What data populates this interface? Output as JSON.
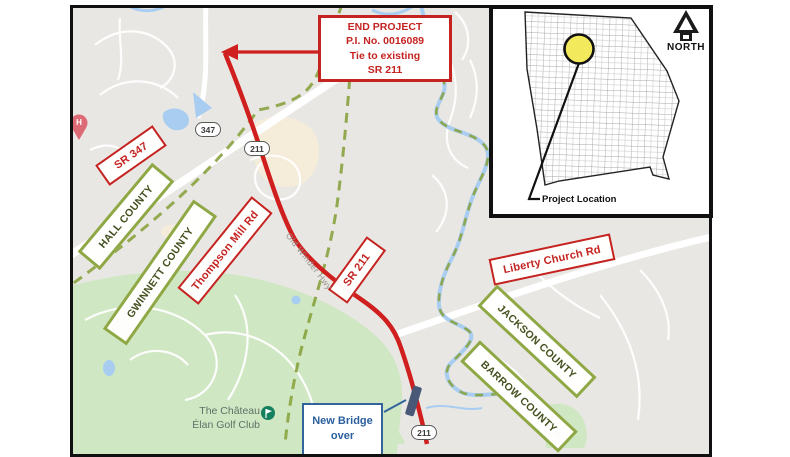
{
  "main_map": {
    "end_project_callout": {
      "lines": [
        "END PROJECT",
        "P.I. No. 0016089",
        "Tie to existing",
        "SR 211"
      ]
    },
    "road_labels": {
      "sr_347": "SR 347",
      "thompson_mill": "Thompson Mill Rd",
      "sr_211": "SR 211",
      "liberty_church": "Liberty Church Rd"
    },
    "county_labels": {
      "hall": "HALL COUNTY",
      "gwinnett": "GWINNETT COUNTY",
      "jackson": "JACKSON COUNTY",
      "barrow": "BARROW COUNTY"
    },
    "route_shields": {
      "sr_347": "347",
      "sr_211_north": "211",
      "sr_211_south": "211"
    },
    "street_name": "Old Winder Hwy",
    "bridge_callout": {
      "lines": [
        "New Bridge",
        "over"
      ]
    },
    "pois": {
      "golf_club_line1": "The Château",
      "golf_club_line2": "Élan Golf Club",
      "hospital_marker": "H"
    }
  },
  "inset_map": {
    "north_label": "NORTH",
    "project_location_label": "Project Location"
  },
  "colors": {
    "route_red": "#cf1f1f",
    "label_red": "#c42320",
    "county_border_green": "#8fa845",
    "county_line_green": "#8aa33f",
    "park_green": "#cfe7c2",
    "water_blue": "#a9cdf0",
    "bridge_marker_navy": "#4a5878",
    "callout_blue": "#33659c",
    "highlight_yellow": "#f2ea5c",
    "hospital_pink": "#dd6b75",
    "golf_icon_green": "#15805e"
  }
}
